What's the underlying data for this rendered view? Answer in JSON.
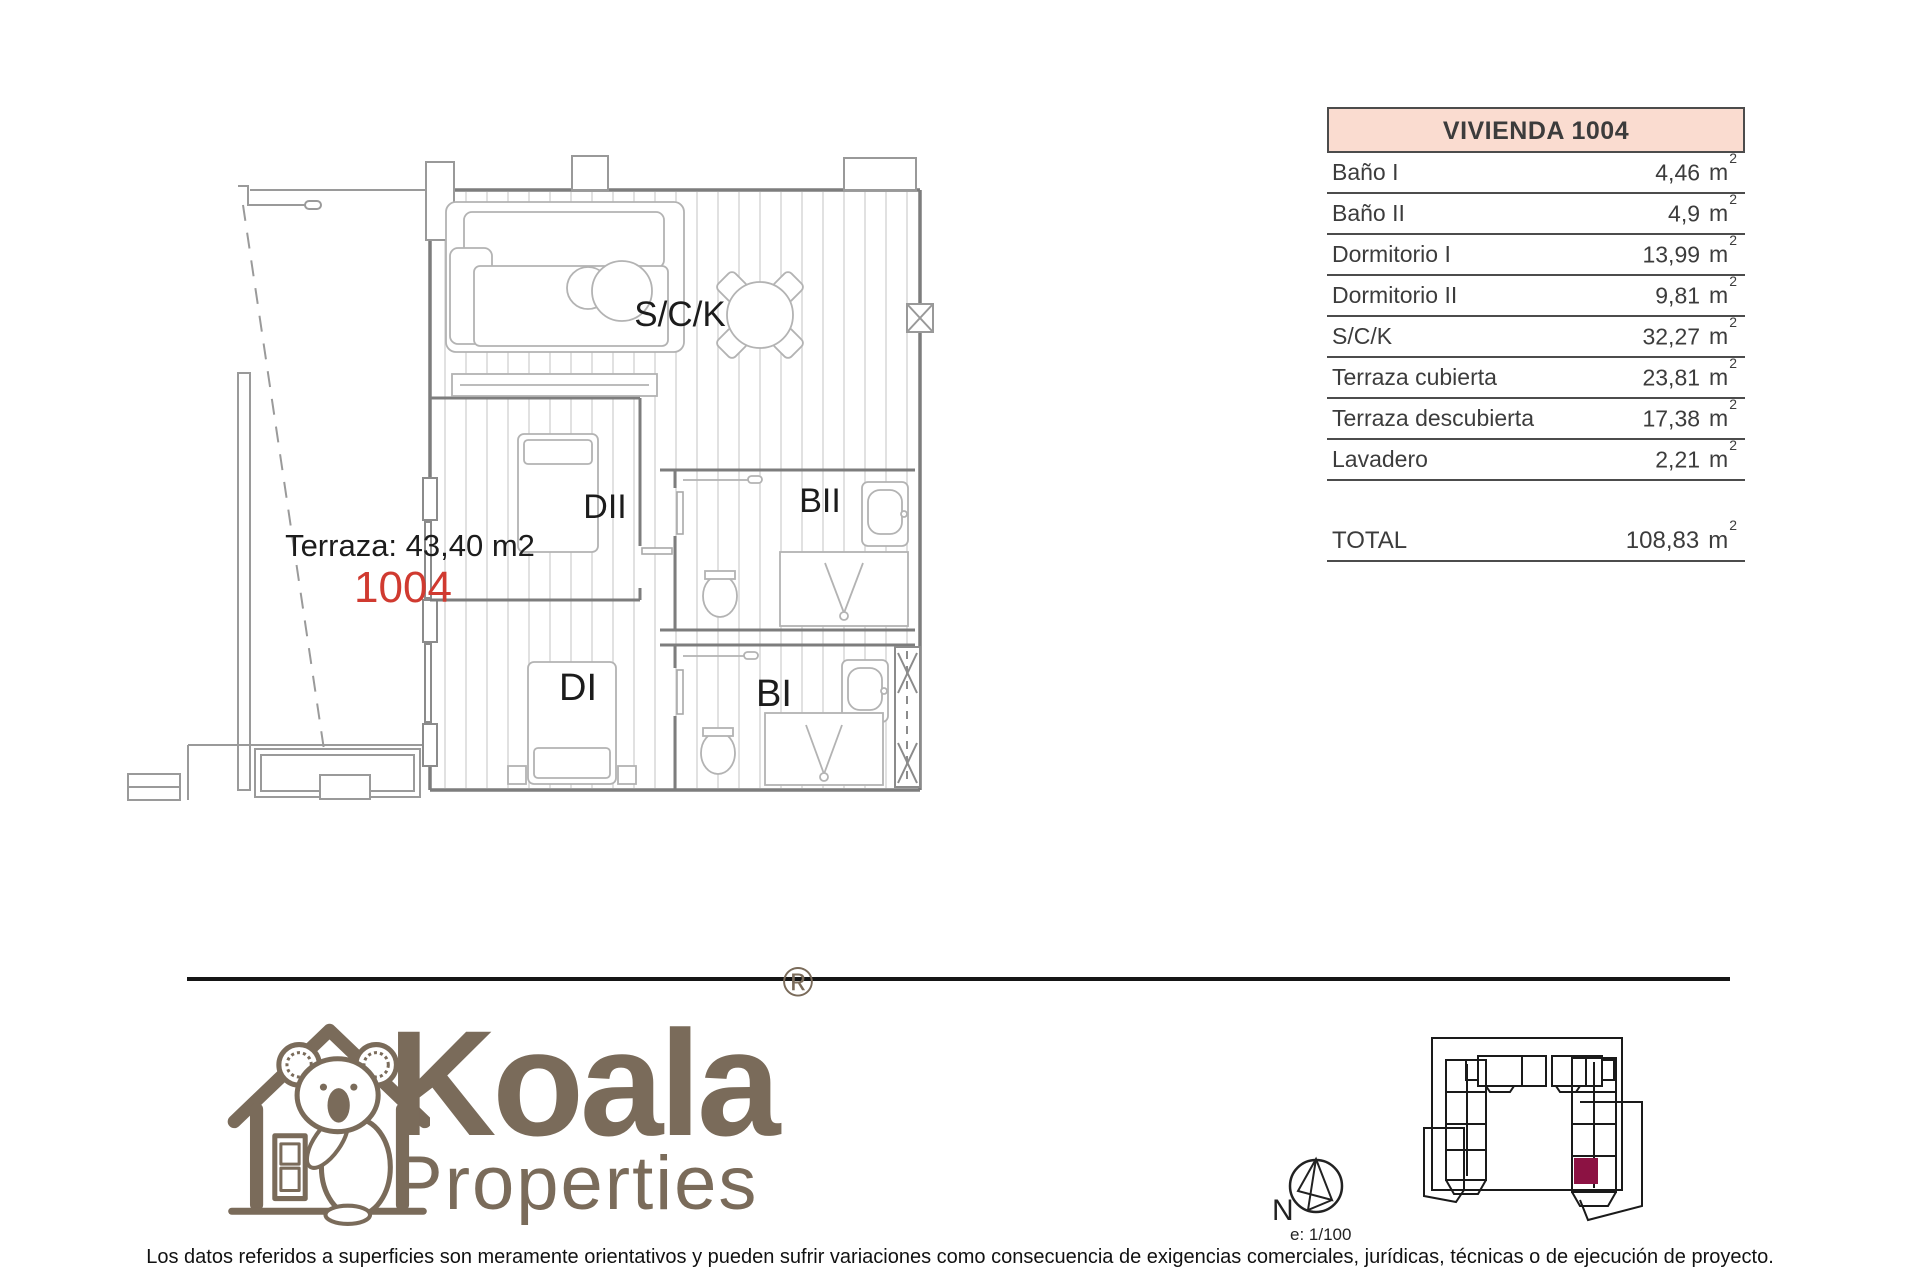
{
  "colors": {
    "accent_red": "#d03a30",
    "table_header_bg": "#fadcd0",
    "brand_brown": "#7a6b5a",
    "maroon": "#8c1243",
    "wall_gray": "#7d7d7d"
  },
  "floorplan": {
    "terrace_label": "Terraza: 43,40 m2",
    "unit_number": "1004",
    "rooms": {
      "sck": "S/C/K",
      "dii": "DII",
      "bii": "BII",
      "di": "DI",
      "bi": "BI"
    }
  },
  "table": {
    "header": "VIVIENDA 1004",
    "unit": "m",
    "sup": "2",
    "rows": [
      {
        "label": "Baño I",
        "value": "4,46"
      },
      {
        "label": "Baño II",
        "value": "4,9"
      },
      {
        "label": "Dormitorio I",
        "value": "13,99"
      },
      {
        "label": "Dormitorio II",
        "value": "9,81"
      },
      {
        "label": "S/C/K",
        "value": "32,27"
      },
      {
        "label": "Terraza cubierta",
        "value": "23,81"
      },
      {
        "label": "Terraza descubierta",
        "value": "17,38"
      },
      {
        "label": "Lavadero",
        "value": "2,21"
      }
    ],
    "total": {
      "label": "TOTAL",
      "value": "108,83"
    }
  },
  "footer": {
    "brand_name": "Koala",
    "brand_reg": "®",
    "brand_sub": "Properties",
    "compass_n": "N",
    "scale_label": "e: 1/100",
    "disclaimer": "Los datos referidos a superficies son meramente orientativos y pueden sufrir variaciones como consecuencia de exigencias comerciales, jurídicas, técnicas o de ejecución de proyecto."
  }
}
